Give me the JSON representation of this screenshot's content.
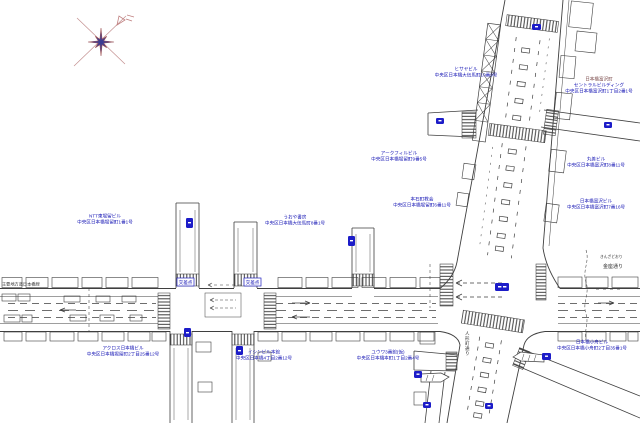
{
  "colors": {
    "background": "#ffffff",
    "line": "#3f3f3f",
    "label_blue": "#1414b4",
    "badge_blue": "#1c1cc8",
    "compass_star": "#3c3c92",
    "compass_rose": "#c49090",
    "label_dark_red": "#7a4a4a"
  },
  "roads": {
    "main_road": {
      "kana": "きんざどおり",
      "name": "金座通り",
      "left_label": "主要地方道日本橋線"
    },
    "diagonal_road": {
      "name": "人形町通り"
    },
    "intersection_signs": [
      {
        "label": "交差点"
      },
      {
        "label": "交差点"
      }
    ]
  },
  "buildings": [
    {
      "name": "ヒサヤビル",
      "address": "中央区日本橋大伝馬町10番9号"
    },
    {
      "name": "日本橋富沢町",
      "name2": "セントラルビルディング",
      "address": "中央区日本橋富沢町1丁目2番1号"
    },
    {
      "name": "アークフィルビル",
      "address": "中央区日本橋堀留町9番5号"
    },
    {
      "name": "丸善ビル",
      "address": "中央区日本橋富沢町8番11号"
    },
    {
      "name": "本石町教会",
      "address": "中央区日本橋堀留町6番11号"
    },
    {
      "name": "日本橋富沢ビル",
      "address": "中央区日本橋富沢町7番16号"
    },
    {
      "name": "NTT東堀留ビル",
      "address": "中央区日本橋堀留町1番1号"
    },
    {
      "name": "うおや書房",
      "address": "中央区日本橋大伝馬町8番1号"
    },
    {
      "name": "アクロス日本橋ビル",
      "address": "中央区日本橋堀留町2丁目25番12号"
    },
    {
      "name": "イシンビル本館",
      "address": "中央区日本橋4丁目2番12号"
    },
    {
      "name": "ユウワ3番館(仮)",
      "address": "中央区日本橋本町1丁目2番4号"
    },
    {
      "name": "日本橋小舟ビル",
      "address": "中央区日本橋小舟町2丁目35番1号"
    }
  ]
}
